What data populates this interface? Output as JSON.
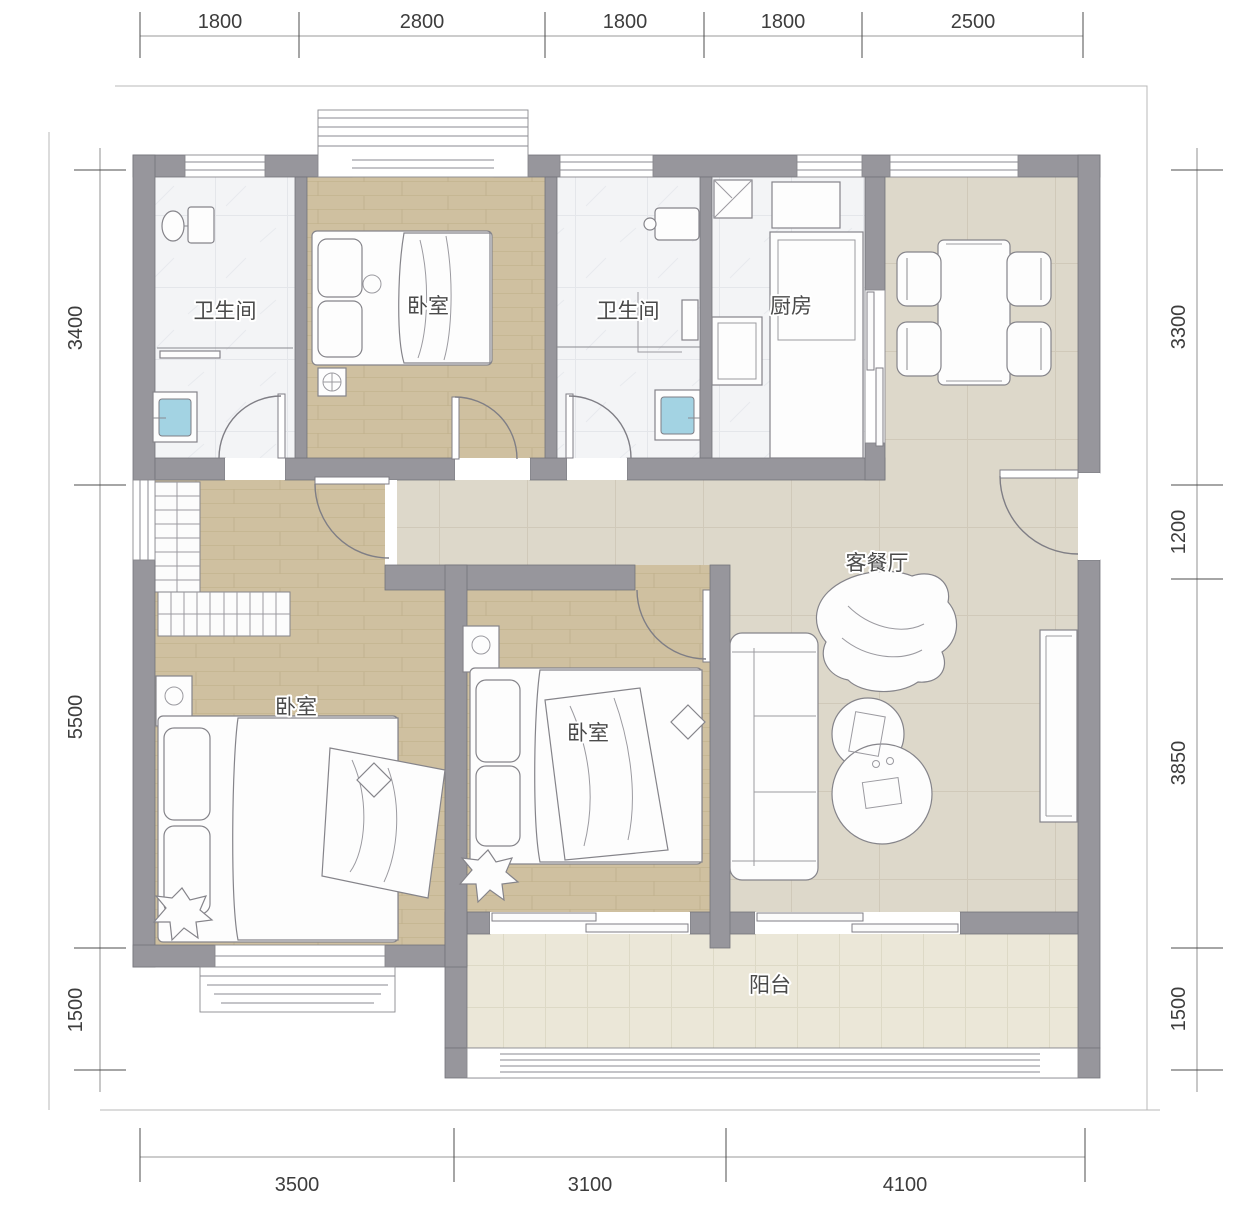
{
  "rooms": {
    "bathroom_1": {
      "label": "卫生间"
    },
    "bedroom_1": {
      "label": "卧室"
    },
    "bathroom_2": {
      "label": "卫生间"
    },
    "kitchen": {
      "label": "厨房"
    },
    "living_dining": {
      "label": "客餐厅"
    },
    "bedroom_2": {
      "label": "卧室"
    },
    "bedroom_3": {
      "label": "卧室"
    },
    "balcony": {
      "label": "阳台"
    }
  },
  "dimensions": {
    "top": [
      "1800",
      "2800",
      "1800",
      "1800",
      "2500"
    ],
    "bottom": [
      "3500",
      "3100",
      "4100"
    ],
    "left": [
      "3400",
      "5500",
      "1500"
    ],
    "right": [
      "3300",
      "1200",
      "3850",
      "1500"
    ]
  },
  "colors": {
    "wall": "#97969c",
    "wood_floor": "#cfc0a0",
    "tile_floor": "#ddd8ca",
    "balcony_floor": "#ebe7d8",
    "wet_floor": "#f3f4f6",
    "washer_blue": "#a3d3e3"
  }
}
